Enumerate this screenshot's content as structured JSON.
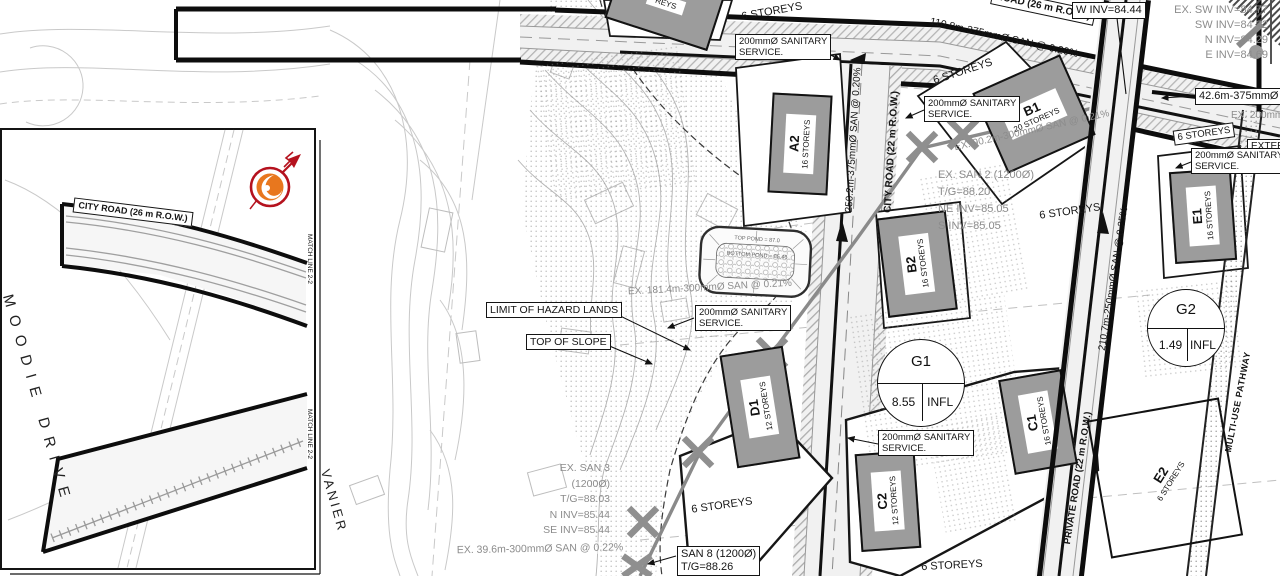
{
  "colors": {
    "accent_orange": "#e8771e",
    "accent_red": "#b5121e",
    "building_fill": "#9c9c9c",
    "existing_gray": "#8c8c8c"
  },
  "inset": {
    "city_road": "CITY ROAD (26 m R.O.W.)",
    "moodie_drive": "MOODIE DRIVE",
    "match_line_a": "MATCH LINE 2-2",
    "match_line_b": "MATCH LINE 2-2",
    "vanier": "VANIER"
  },
  "roads": {
    "road26": "ROAD (26 m R.O.W.)",
    "city22": "CITY ROAD (22 m R.O.W.)",
    "private22": "PRIVATE ROAD (22 m R.O.W.)",
    "pathway": "MULTI-USE PATHWAY"
  },
  "mains": {
    "top": "110.8m-375mmØ SAN @ 0.20%",
    "city": "250.2m-375mmØ SAN @ 0.20%",
    "private": "210.7m-250mmØ SAN @ 0.25%",
    "seg42": "42.6m-375mmØ SAN",
    "ex90": "EX. 90.2m-300mmØ SAN @ 0.21%",
    "ex181": "EX. 181.4m-300mmØ SAN @ 0.21%",
    "ex39": "EX. 39.6m-300mmØ SAN @ 0.22%",
    "ex200": "EX. 200mmØ",
    "external": "EXTERNAL"
  },
  "service": {
    "label": "200mmØ SANITARY\nSERVICE."
  },
  "manholes": {
    "w_inv": "W INV=84.44",
    "junction": "EX. SW INV=84.77\nSW INV=84.32\nN INV=84.29\nE INV=84.69",
    "san2": "EX. SAN 2 (1200Ø)\nT/G=88.20\nNE INV=85.05\nS INV=85.05",
    "san3": "EX. SAN 3 (1200Ø)\nT/G=88.03\nN INV=85.44\nSE INV=85.44",
    "san8": "SAN 8 (1200Ø)\nT/G=88.26"
  },
  "notes": {
    "hazard": "LIMIT OF HAZARD LANDS",
    "slope": "TOP OF SLOPE"
  },
  "pond": {
    "top": "TOP POND = 87.0",
    "bottom": "BOTTOM POND = 85.46"
  },
  "buildings": [
    {
      "id": "A2",
      "storeys": "16 STOREYS"
    },
    {
      "id": "B1",
      "storeys": "20 STOREYS"
    },
    {
      "id": "B2",
      "storeys": "16 STOREYS"
    },
    {
      "id": "C1",
      "storeys": "16 STOREYS"
    },
    {
      "id": "C2",
      "storeys": "12 STOREYS"
    },
    {
      "id": "D1",
      "storeys": "12 STOREYS"
    },
    {
      "id": "E1",
      "storeys": "16 STOREYS"
    },
    {
      "id": "E2",
      "storeys": "6 STOREYS"
    }
  ],
  "labels": {
    "six_storeys": "6 STOREYS",
    "partial_storeys": "REYS"
  },
  "catchments": [
    {
      "id": "G1",
      "value": "8.55",
      "tag": "INFL"
    },
    {
      "id": "G2",
      "value": "1.49",
      "tag": "INFL"
    }
  ]
}
